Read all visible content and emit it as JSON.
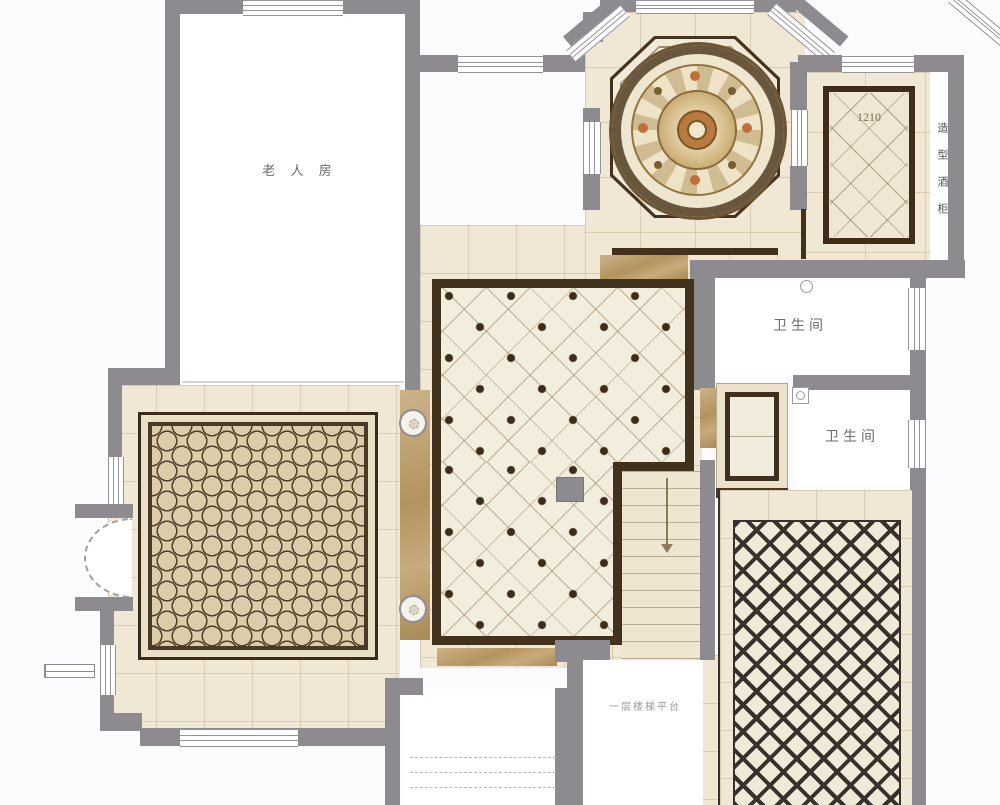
{
  "plan": {
    "rooms": {
      "elder_room": {
        "label": "老 人 房"
      },
      "bathroom_upper": {
        "label": "卫生间"
      },
      "bathroom_lower": {
        "label": "卫生间"
      },
      "wine_cabinet": {
        "label": "造型酒柜"
      },
      "stair_landing": {
        "label": "一层楼梯平台"
      }
    },
    "annotations": {
      "tile_code": "1210"
    },
    "colors": {
      "wall_gray": "#8d8b90",
      "tile_cream": "#f1e9d6",
      "border_dark_brown": "#42311d",
      "marble_tan": "#c0a273",
      "rug_beige": "#dbcda9",
      "medallion_orange": "#c06f3a",
      "room_white": "#ffffff"
    },
    "icons": {
      "stairs_arrow": "down-arrow",
      "bathroom_upper_fixture": "floor-drain",
      "bathroom_lower_fixture": "floor-drain"
    }
  }
}
